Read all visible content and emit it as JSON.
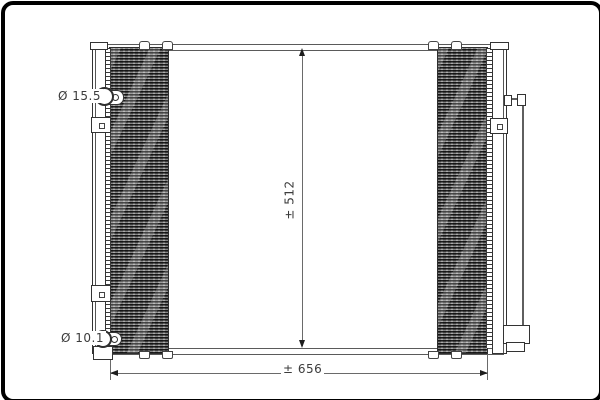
{
  "image": {
    "type": "technical-drawing",
    "subject": "ac-condenser-front-view",
    "background": "#ffffff",
    "frame_color": "#000000",
    "line_color": "#3c3c3c",
    "core_fill": "#7b7b7b"
  },
  "annotations": {
    "top_left_port": "Ø 15.5",
    "bottom_left_port": "Ø 10.1",
    "height_dim": "± 512",
    "width_dim": "± 656"
  }
}
